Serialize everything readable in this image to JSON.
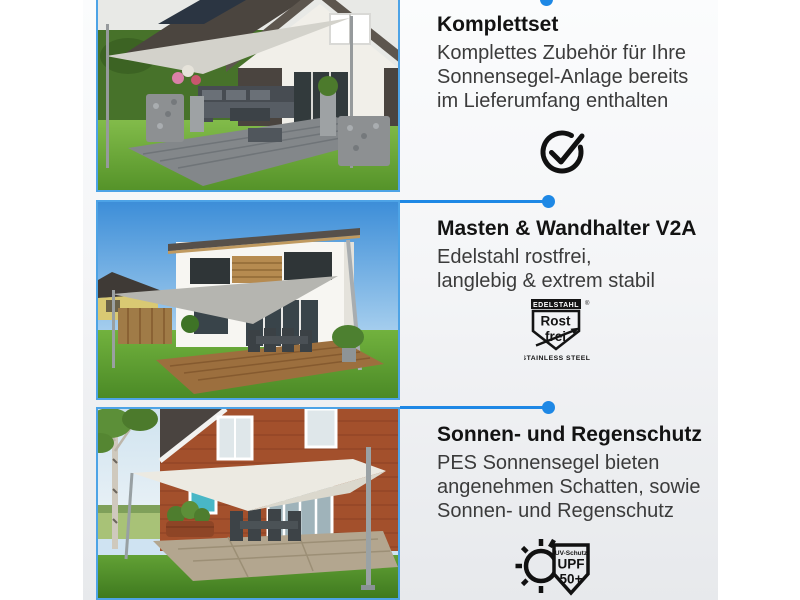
{
  "canvas": {
    "background": "#ffffff",
    "content_background_top": "#fbfcfd",
    "content_background_bottom": "#e7e9ec"
  },
  "accent": {
    "connector_blue": "#1e88e5",
    "photo_border_blue": "#4da3e6"
  },
  "sections": [
    {
      "id": "komplettset",
      "heading": "Komplettset",
      "lines": [
        "Komplettes Zubehör für Ihre",
        "Sonnensegel-Anlage bereits",
        "im Lieferumfang enthalten"
      ],
      "icon": "check-circle-icon"
    },
    {
      "id": "masten-wandhalter",
      "heading": "Masten & Wandhalter V2A",
      "lines": [
        "Edelstahl rostfrei,",
        "langlebig & extrem stabil"
      ],
      "icon": "rostfrei-seal-icon",
      "seal": {
        "top_label": "EDELSTAHL",
        "registered": "®",
        "word1": "Rost",
        "word2": "frei",
        "bottom_label": "STAINLESS STEEL"
      }
    },
    {
      "id": "sonnen-regenschutz",
      "heading": "Sonnen- und Regenschutz",
      "lines": [
        "PES Sonnensegel bieten",
        "angenehmen Schatten, sowie",
        "Sonnen- und Regenschutz"
      ],
      "icon": "upf-seal-icon",
      "seal": {
        "small_label": "UV-Schutz",
        "word1": "UPF",
        "word2": "50+"
      }
    }
  ],
  "photos": [
    {
      "desc": "Graues Sonnensegel über Terrasse mit Lounge-Möbeln"
    },
    {
      "desc": "Weißes modernes Haus mit grauem Sonnensegel über Holzterrasse"
    },
    {
      "desc": "Backsteinhaus mit weißem Sonnensegel über Steinterrasse"
    }
  ]
}
